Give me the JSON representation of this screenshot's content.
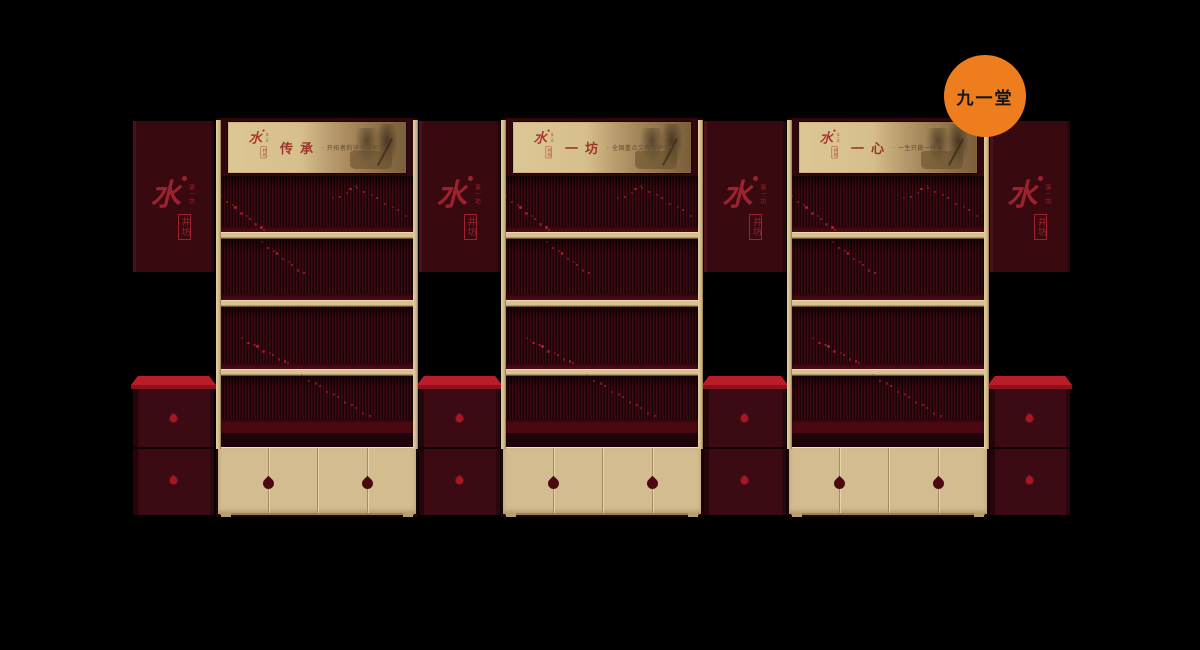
{
  "badge": {
    "label": "九一堂",
    "bg_color": "#ee7d1e"
  },
  "brand": {
    "full_name": "水井坊",
    "logo_main_char": "水",
    "logo_boxed_chars": "井坊",
    "logo_side_text": "第一坊"
  },
  "banners": [
    {
      "title": "传承",
      "subtitle": "· 开拓者的坚守与担当"
    },
    {
      "title": "一坊",
      "subtitle": "· 全国重点文物保护单位"
    },
    {
      "title": "一心",
      "subtitle": "· 一生只做一件事"
    }
  ],
  "colors": {
    "background": "#000000",
    "accent_orange": "#ee7d1e",
    "brand_red": "#9c2230",
    "counter_red": "#b91d28",
    "wood_cream": "#d3bd90",
    "panel_maroon": "#38090f",
    "slat_red": "#420a12"
  }
}
